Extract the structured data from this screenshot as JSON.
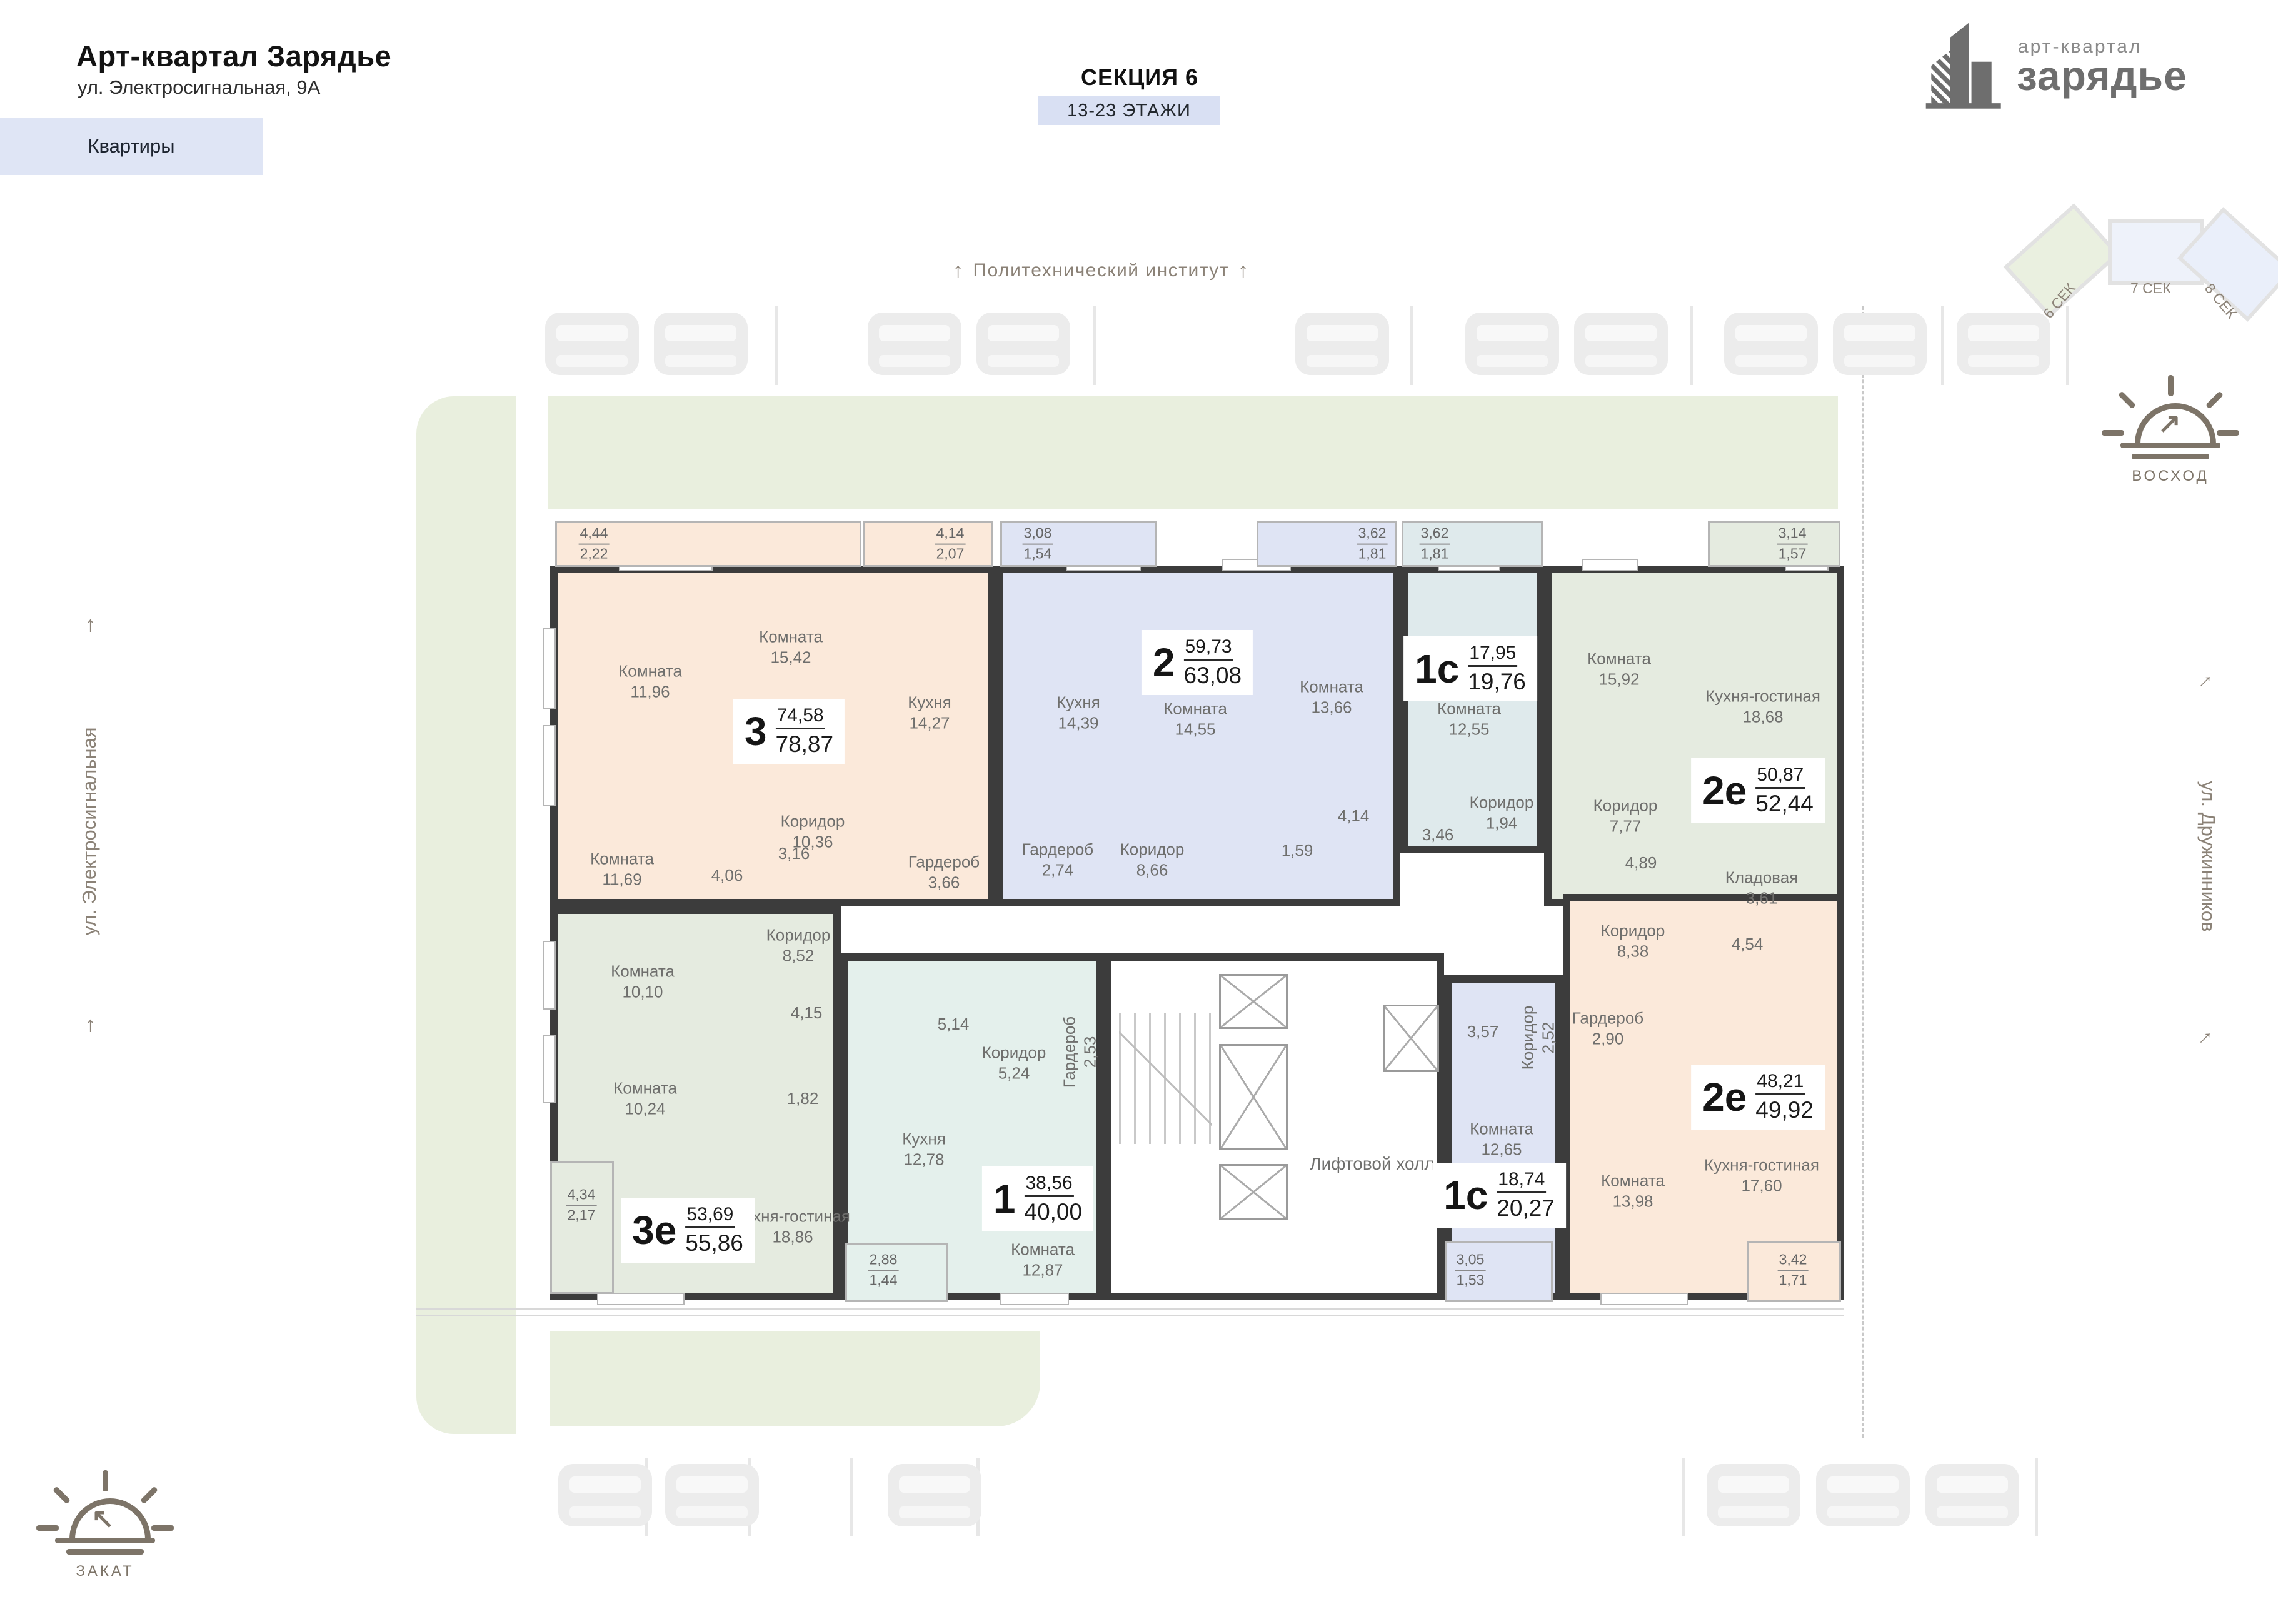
{
  "header": {
    "title": "Арт-квартал Зарядье",
    "address": "ул. Электросигнальная, 9А",
    "nav_chip": "Квартиры",
    "section_title": "СЕКЦИЯ 6",
    "floors_badge": "13-23 ЭТАЖИ",
    "landmark_top": "Политехнический институт"
  },
  "logo": {
    "line1": "арт-квартал",
    "line2": "зарядье"
  },
  "minimap": {
    "sections": [
      {
        "label": "6 СЕК"
      },
      {
        "label": "7 СЕК"
      },
      {
        "label": "8 СЕК"
      }
    ],
    "active": "6 СЕК"
  },
  "orientation": {
    "sunrise": "ВОСХОД",
    "sunset": "ЗАКАТ"
  },
  "streets": {
    "left": "ул. Электросигнальная",
    "right": "ул. Дружинников"
  },
  "plan": {
    "elevator_hall": "Лифтовой холл"
  },
  "apartments": [
    {
      "id": "apt-3",
      "type": "3",
      "living": "74,58",
      "total": "78,87",
      "rooms": [
        {
          "name": "Комната",
          "area": "11,96"
        },
        {
          "name": "Комната",
          "area": "15,42"
        },
        {
          "name": "Кухня",
          "area": "14,27"
        },
        {
          "name": "Коридор",
          "area": "10,36"
        },
        {
          "name": "Комната",
          "area": "11,69"
        },
        {
          "name": "",
          "area": "4,06"
        },
        {
          "name": "",
          "area": "3,16"
        },
        {
          "name": "Гардероб",
          "area": "3,66"
        }
      ],
      "balconies": [
        {
          "a": "4,44",
          "b": "2,22"
        },
        {
          "a": "4,14",
          "b": "2,07"
        }
      ]
    },
    {
      "id": "apt-2",
      "type": "2",
      "living": "59,73",
      "total": "63,08",
      "rooms": [
        {
          "name": "Кухня",
          "area": "14,39"
        },
        {
          "name": "Комната",
          "area": "14,55"
        },
        {
          "name": "Комната",
          "area": "13,66"
        },
        {
          "name": "Гардероб",
          "area": "2,74"
        },
        {
          "name": "Коридор",
          "area": "8,66"
        },
        {
          "name": "",
          "area": "1,59"
        },
        {
          "name": "",
          "area": "4,14"
        }
      ],
      "balconies": [
        {
          "a": "3,08",
          "b": "1,54"
        },
        {
          "a": "3,62",
          "b": "1,81"
        }
      ]
    },
    {
      "id": "apt-1c-top",
      "type": "1с",
      "living": "17,95",
      "total": "19,76",
      "rooms": [
        {
          "name": "Комната",
          "area": "12,55"
        },
        {
          "name": "Коридор",
          "area": "1,94"
        },
        {
          "name": "",
          "area": "3,46"
        }
      ],
      "balconies": [
        {
          "a": "3,62",
          "b": "1,81"
        }
      ]
    },
    {
      "id": "apt-2e-top",
      "type": "2е",
      "living": "50,87",
      "total": "52,44",
      "rooms": [
        {
          "name": "Комната",
          "area": "15,92"
        },
        {
          "name": "Кухня-гостиная",
          "area": "18,68"
        },
        {
          "name": "Коридор",
          "area": "7,77"
        },
        {
          "name": "",
          "area": "4,89"
        },
        {
          "name": "Кладовая",
          "area": "3,61"
        }
      ],
      "balconies": [
        {
          "a": "3,14",
          "b": "1,57"
        }
      ]
    },
    {
      "id": "apt-2e-bottom",
      "type": "2е",
      "living": "48,21",
      "total": "49,92",
      "rooms": [
        {
          "name": "Коридор",
          "area": "8,38"
        },
        {
          "name": "",
          "area": "4,54"
        },
        {
          "name": "Гардероб",
          "area": "2,90"
        },
        {
          "name": "Комната",
          "area": "13,98"
        },
        {
          "name": "Кухня-гостиная",
          "area": "17,60"
        }
      ],
      "balconies": [
        {
          "a": "3,42",
          "b": "1,71"
        }
      ]
    },
    {
      "id": "apt-1c-bottom",
      "type": "1с",
      "living": "18,74",
      "total": "20,27",
      "rooms": [
        {
          "name": "",
          "area": "3,57"
        },
        {
          "name": "Коридор",
          "area": "2,52"
        },
        {
          "name": "Комната",
          "area": "12,65"
        }
      ],
      "balconies": [
        {
          "a": "3,05",
          "b": "1,53"
        }
      ]
    },
    {
      "id": "apt-1",
      "type": "1",
      "living": "38,56",
      "total": "40,00",
      "rooms": [
        {
          "name": "",
          "area": "5,14"
        },
        {
          "name": "Коридор",
          "area": "5,24"
        },
        {
          "name": "Гардероб",
          "area": "2,53"
        },
        {
          "name": "Кухня",
          "area": "12,78"
        },
        {
          "name": "Комната",
          "area": "12,87"
        }
      ],
      "balconies": [
        {
          "a": "2,88",
          "b": "1,44"
        }
      ]
    },
    {
      "id": "apt-3e",
      "type": "3е",
      "living": "53,69",
      "total": "55,86",
      "rooms": [
        {
          "name": "Комната",
          "area": "10,10"
        },
        {
          "name": "Коридор",
          "area": "8,52"
        },
        {
          "name": "",
          "area": "4,15"
        },
        {
          "name": "Комната",
          "area": "10,24"
        },
        {
          "name": "",
          "area": "1,82"
        },
        {
          "name": "Кухня-гостиная",
          "area": "18,86"
        }
      ],
      "balconies": [
        {
          "a": "4,34",
          "b": "2,17"
        }
      ]
    }
  ],
  "colors": {
    "wall": "#3c3c3c",
    "peach": "#fbe9da",
    "lavender": "#dfe4f4",
    "mint": "#dfeaec",
    "sage": "#e5ebe0",
    "teal": "#e4f0ec",
    "green_strip": "#e9efde",
    "chip_bg": "#dfe5f5",
    "floors_badge_bg": "#d9e0f3",
    "muted_text": "#8b8277"
  }
}
